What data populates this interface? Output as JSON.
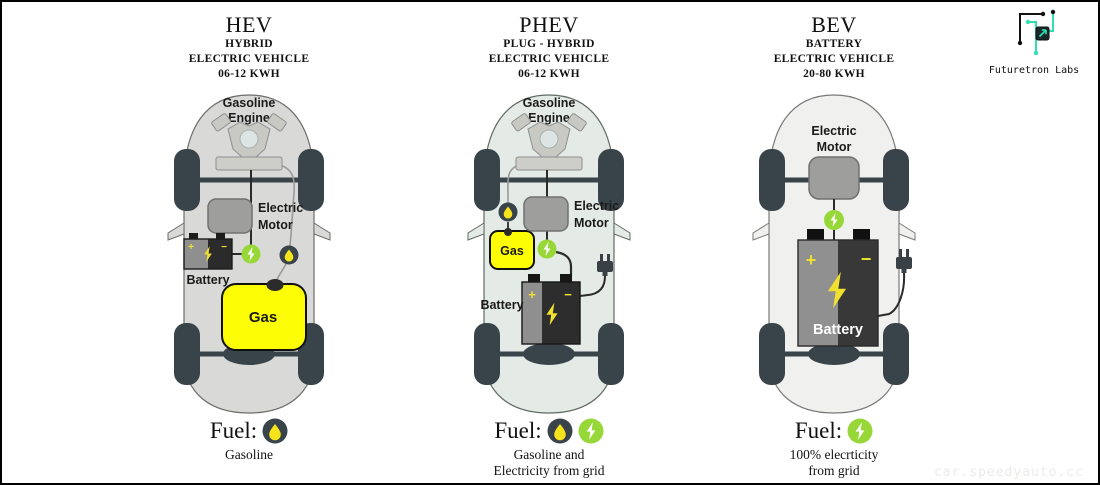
{
  "logo": {
    "name": "Futuretron Labs"
  },
  "watermark": "car.speedyauto.cc",
  "colors": {
    "electric_green": "#97d838",
    "gas_yellow": "#fdfd05",
    "bolt_yellow": "#f0e130",
    "dark_slate": "#39434a",
    "logo_teal": "#2fe0b4",
    "hev_body": "#d9d9d7",
    "phev_body": "#e4eae5",
    "bev_body": "#f0f0ee"
  },
  "columns": [
    {
      "id": "hev",
      "title": "HEV",
      "subtitle": [
        "HYBRID",
        "ELECTRIC VEHICLE",
        "06-12 KWH"
      ],
      "car": {
        "engine_label": [
          "Gasoline",
          "Engine"
        ],
        "motor_label": [
          "Electric",
          "Motor"
        ],
        "battery_label": "Battery",
        "gas_label": "Gas",
        "battery_plus": "+",
        "battery_minus": "−"
      },
      "fuel": {
        "label": "Fuel:",
        "icons": [
          "gasoline-drop"
        ],
        "caption": [
          "Gasoline"
        ]
      }
    },
    {
      "id": "phev",
      "title": "PHEV",
      "subtitle": [
        "PLUG - HYBRID",
        "ELECTRIC VEHICLE",
        "06-12 KWH"
      ],
      "car": {
        "engine_label": [
          "Gasoline",
          "Engine"
        ],
        "motor_label": [
          "Electric",
          "Motor"
        ],
        "battery_label": "Battery",
        "gas_label": "Gas",
        "battery_plus": "+",
        "battery_minus": "−"
      },
      "fuel": {
        "label": "Fuel:",
        "icons": [
          "gasoline-drop",
          "electricity-bolt"
        ],
        "caption": [
          "Gasoline and",
          "Electricity from grid"
        ]
      }
    },
    {
      "id": "bev",
      "title": "BEV",
      "subtitle": [
        "BATTERY",
        "ELECTRIC VEHICLE",
        "20-80 KWH"
      ],
      "car": {
        "motor_label": [
          "Electric",
          "Motor"
        ],
        "battery_label": "Battery",
        "battery_plus": "+",
        "battery_minus": "−"
      },
      "fuel": {
        "label": "Fuel:",
        "icons": [
          "electricity-bolt"
        ],
        "caption": [
          "100% elecrticity",
          "from grid"
        ]
      }
    }
  ]
}
